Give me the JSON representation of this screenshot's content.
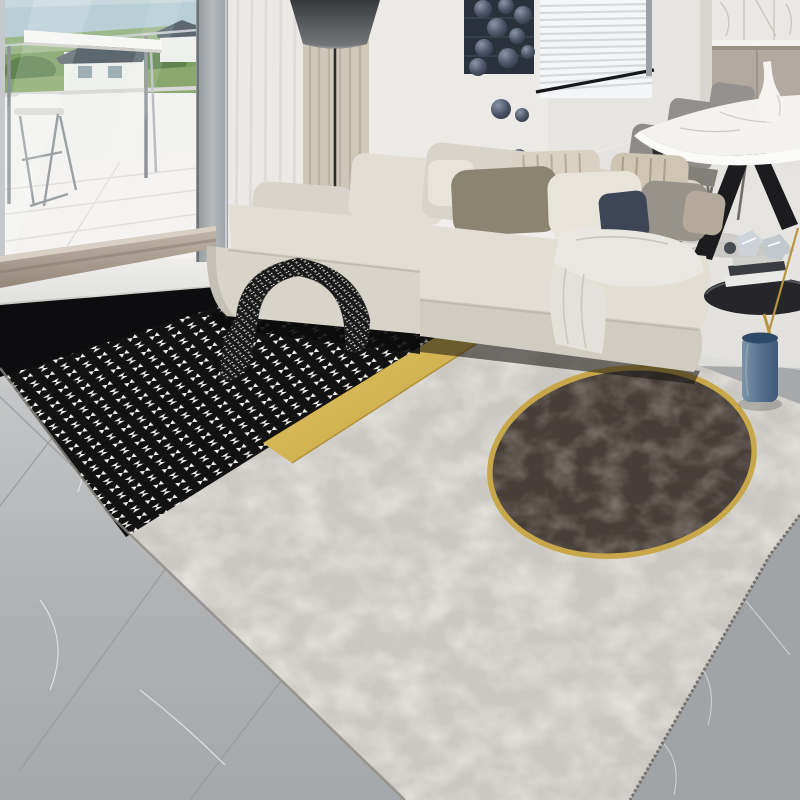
{
  "scene": {
    "type": "photograph",
    "description": "Modern living room product photo of a large area rug: black band and black-white houndstooth section joined by a diagonal gold stripe to a mottled concrete-grey section containing a large dark-brown circle with a gold ring. Cream L-shaped sectional sofa with pillows and throws sits on the rug; balcony window at left, wall art spheres and blinds at top, marble dining table with taupe chairs at right, round black side table and blue vase; grey marble tile floor.",
    "objects": [
      "balcony-window",
      "bar-stool",
      "glass-railing",
      "outdoor-view-houses",
      "sheer-curtain",
      "textured-curtain",
      "floor-lamp",
      "wall-art-sphere-panel",
      "window-blinds",
      "kitchen-cabinets",
      "marble-backsplash",
      "dining-table",
      "dining-chairs",
      "white-vase",
      "sectional-sofa",
      "throw-pillows",
      "houndstooth-throw-blanket",
      "white-throw-blanket",
      "side-table",
      "decor-books",
      "crystal-decor",
      "blue-vase",
      "gold-branch",
      "area-rug",
      "houndstooth-section",
      "black-band",
      "gold-stripe",
      "concrete-grey-section",
      "dark-circle-with-gold-ring",
      "tile-floor",
      "marble-threshold"
    ]
  },
  "rug": {
    "sections": [
      "black-band",
      "houndstooth",
      "gold-diagonal-stripe",
      "concrete-grey",
      "dark-brown-circle-gold-ring"
    ],
    "style": "modern patchwork",
    "fringe": "short serrated fringe on lower-right edge"
  },
  "colors": {
    "wall": "#e7e5e1",
    "wallBright": "#eeedea",
    "frameGrey": "#a9aeb2",
    "frameEdge": "#6d7276",
    "sky": "#c7d9dc",
    "water": "#b7cfd5",
    "greenFar": "#9db88a",
    "green": "#7da065",
    "greenDark": "#5f8450",
    "lawn": "#8aa86d",
    "houseWhite": "#eef0ed",
    "roofGrey": "#5c686e",
    "parapet": "#f2f2f0",
    "balconyFloor": "#f4f3f1",
    "stoolMetal": "#9aa0a3",
    "threshold": "#b0a395",
    "thresholdDark": "#8a7e71",
    "tileSeam": "#989b9e",
    "tileDark": "#a1a4a6",
    "tileVein": "#e6e8e9",
    "rugGrey": "#cbc8c2",
    "rugBlack": "#0d0d0f",
    "houndWhite": "#f4f3ef",
    "houndBlack": "#121212",
    "gold": "#d4b554",
    "goldDark": "#b3923c",
    "circleBrown": "#473e39",
    "ringGold": "#c8a74b",
    "sofaCream": "#d8d4c9",
    "sofaLight": "#e2ded3",
    "sofaFront": "#d0ccc0",
    "sofaSide": "#c4c0b4",
    "sofaShadow": "#0c0c0d",
    "pillowOlive": "#8b8471",
    "pillowKnit": "#e8e4d9",
    "pillowStripe": "#d9d2c2",
    "pillowStripeLine": "#b5ad9a",
    "pillowStripe2": "#cec6b3",
    "pillowGrey": "#98938a",
    "pillowNavy": "#3e4557",
    "pillowTan": "#b3aa9b",
    "curtainSheer": "#ebe9e5",
    "curtainStreak": "#dcdad6",
    "curtainTextured": "#cfc8b9",
    "curtainTexturedLine": "#b7af9f",
    "lampShade": "#54575a",
    "lampPole": "#2a2a2c",
    "artPanel": "#2b313c",
    "blinds": "#f4f5f6",
    "blindSlat": "#d6d9db",
    "blindFrame": "#17171a",
    "cabinet": "#b2a99f",
    "cabinetLine": "#978e83",
    "marble": "#eae8e5",
    "marbleVein": "#c9c5c0",
    "counterWhite": "#f4f3f1",
    "tableMarble": "#f3f2ef",
    "tableRim": "#fafaf8",
    "chairTaupe": "#8e8b88",
    "chairLeg": "#6f6c69",
    "legBlack": "#1c1c1e",
    "tableGlass": "#26262a",
    "stemGold": "#b8943e",
    "vaseBlueTop": "#2f4a66",
    "throwWhite": "#e9e7e1",
    "throwWhiteFold": "#c9c7c0",
    "bookDark": "#3a3e42",
    "bookWhite": "#e8e8e6",
    "crystal": "#ccd3d9"
  }
}
